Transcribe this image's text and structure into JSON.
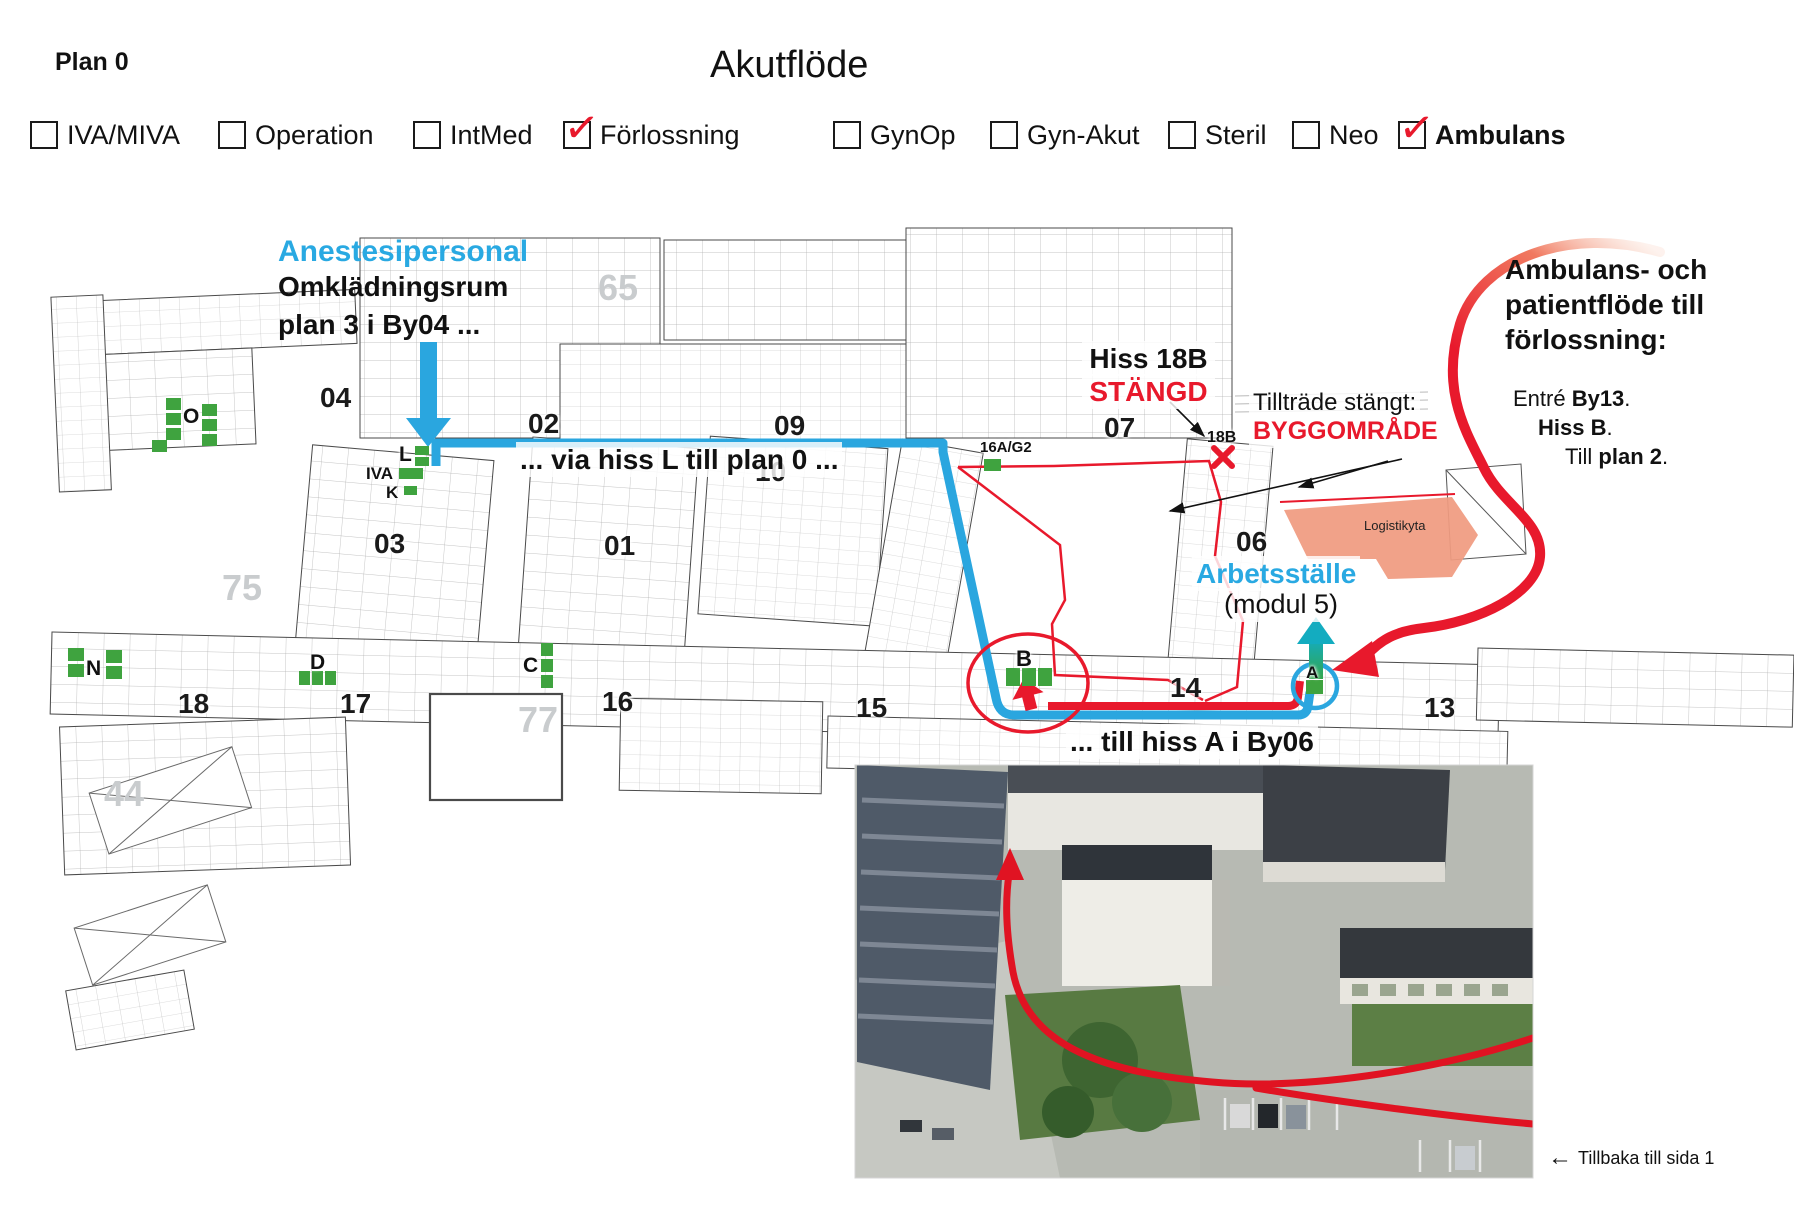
{
  "header": {
    "plan_label": "Plan 0",
    "title": "Akutflöde"
  },
  "legend": {
    "check_glyph": "✓",
    "items": [
      {
        "label": "IVA/MIVA",
        "checked": false
      },
      {
        "label": "Operation",
        "checked": false
      },
      {
        "label": "IntMed",
        "checked": false
      },
      {
        "label": "Förlossning",
        "checked": true
      },
      {
        "label": "GynOp",
        "checked": false
      },
      {
        "label": "Gyn-Akut",
        "checked": false
      },
      {
        "label": "Steril",
        "checked": false
      },
      {
        "label": "Neo",
        "checked": false
      },
      {
        "label": "Ambulans",
        "checked": true
      }
    ]
  },
  "annotations": {
    "anestesi_title": "Anestesipersonal",
    "anestesi_line1": "Omklädningsrum",
    "anestesi_line2": "plan 3 i By04 ...",
    "via_hiss": "... via hiss L till plan 0 ...",
    "hiss18b_line1": "Hiss 18B",
    "hiss18b_line2": "STÄNGD",
    "tilltrade_line1": "Tillträde stängt:",
    "tilltrade_line2": "BYGGOMRÅDE",
    "ambulans_l1": "Ambulans- och",
    "ambulans_l2": "patientflöde till",
    "ambulans_l3": "förlossning:",
    "entre": {
      "prefix": "Entré ",
      "bold": "By13",
      "suffix": "."
    },
    "hiss_b": {
      "bold": "Hiss B",
      "suffix": "."
    },
    "till_plan": {
      "prefix": "Till ",
      "bold": "plan 2",
      "suffix": "."
    },
    "arbetsstalle_l1": "Arbetsställe",
    "arbetsstalle_l2": "(modul 5)",
    "till_hiss_a": "... till hiss A i By06",
    "back_arrow": "←",
    "back_label": "Tillbaka till sida 1"
  },
  "floorplan": {
    "numbers": {
      "n04": "04",
      "n02": "02",
      "n09": "09",
      "n07": "07",
      "n03": "03",
      "n01": "01",
      "n10": "10",
      "n06": "06",
      "n18": "18",
      "n17": "17",
      "n16": "16",
      "n15": "15",
      "n14": "14",
      "n13": "13"
    },
    "faint": {
      "f75": "75",
      "f77": "77",
      "f65": "65",
      "f44": "44"
    },
    "small_labels": {
      "l16ag2": "16A/G2",
      "l18b": "18B",
      "logistik": "Logistikyta"
    },
    "markers": {
      "o": "O",
      "l": "L",
      "iva": "IVA",
      "k": "K",
      "d": "D",
      "c": "C",
      "n": "N",
      "b": "B",
      "a": "A"
    }
  },
  "colors": {
    "accent_cyan": "#29A9E2",
    "alert_red": "#E8192C",
    "marker_green": "#3FA33F",
    "logistics_salmon": "#F09B80"
  }
}
